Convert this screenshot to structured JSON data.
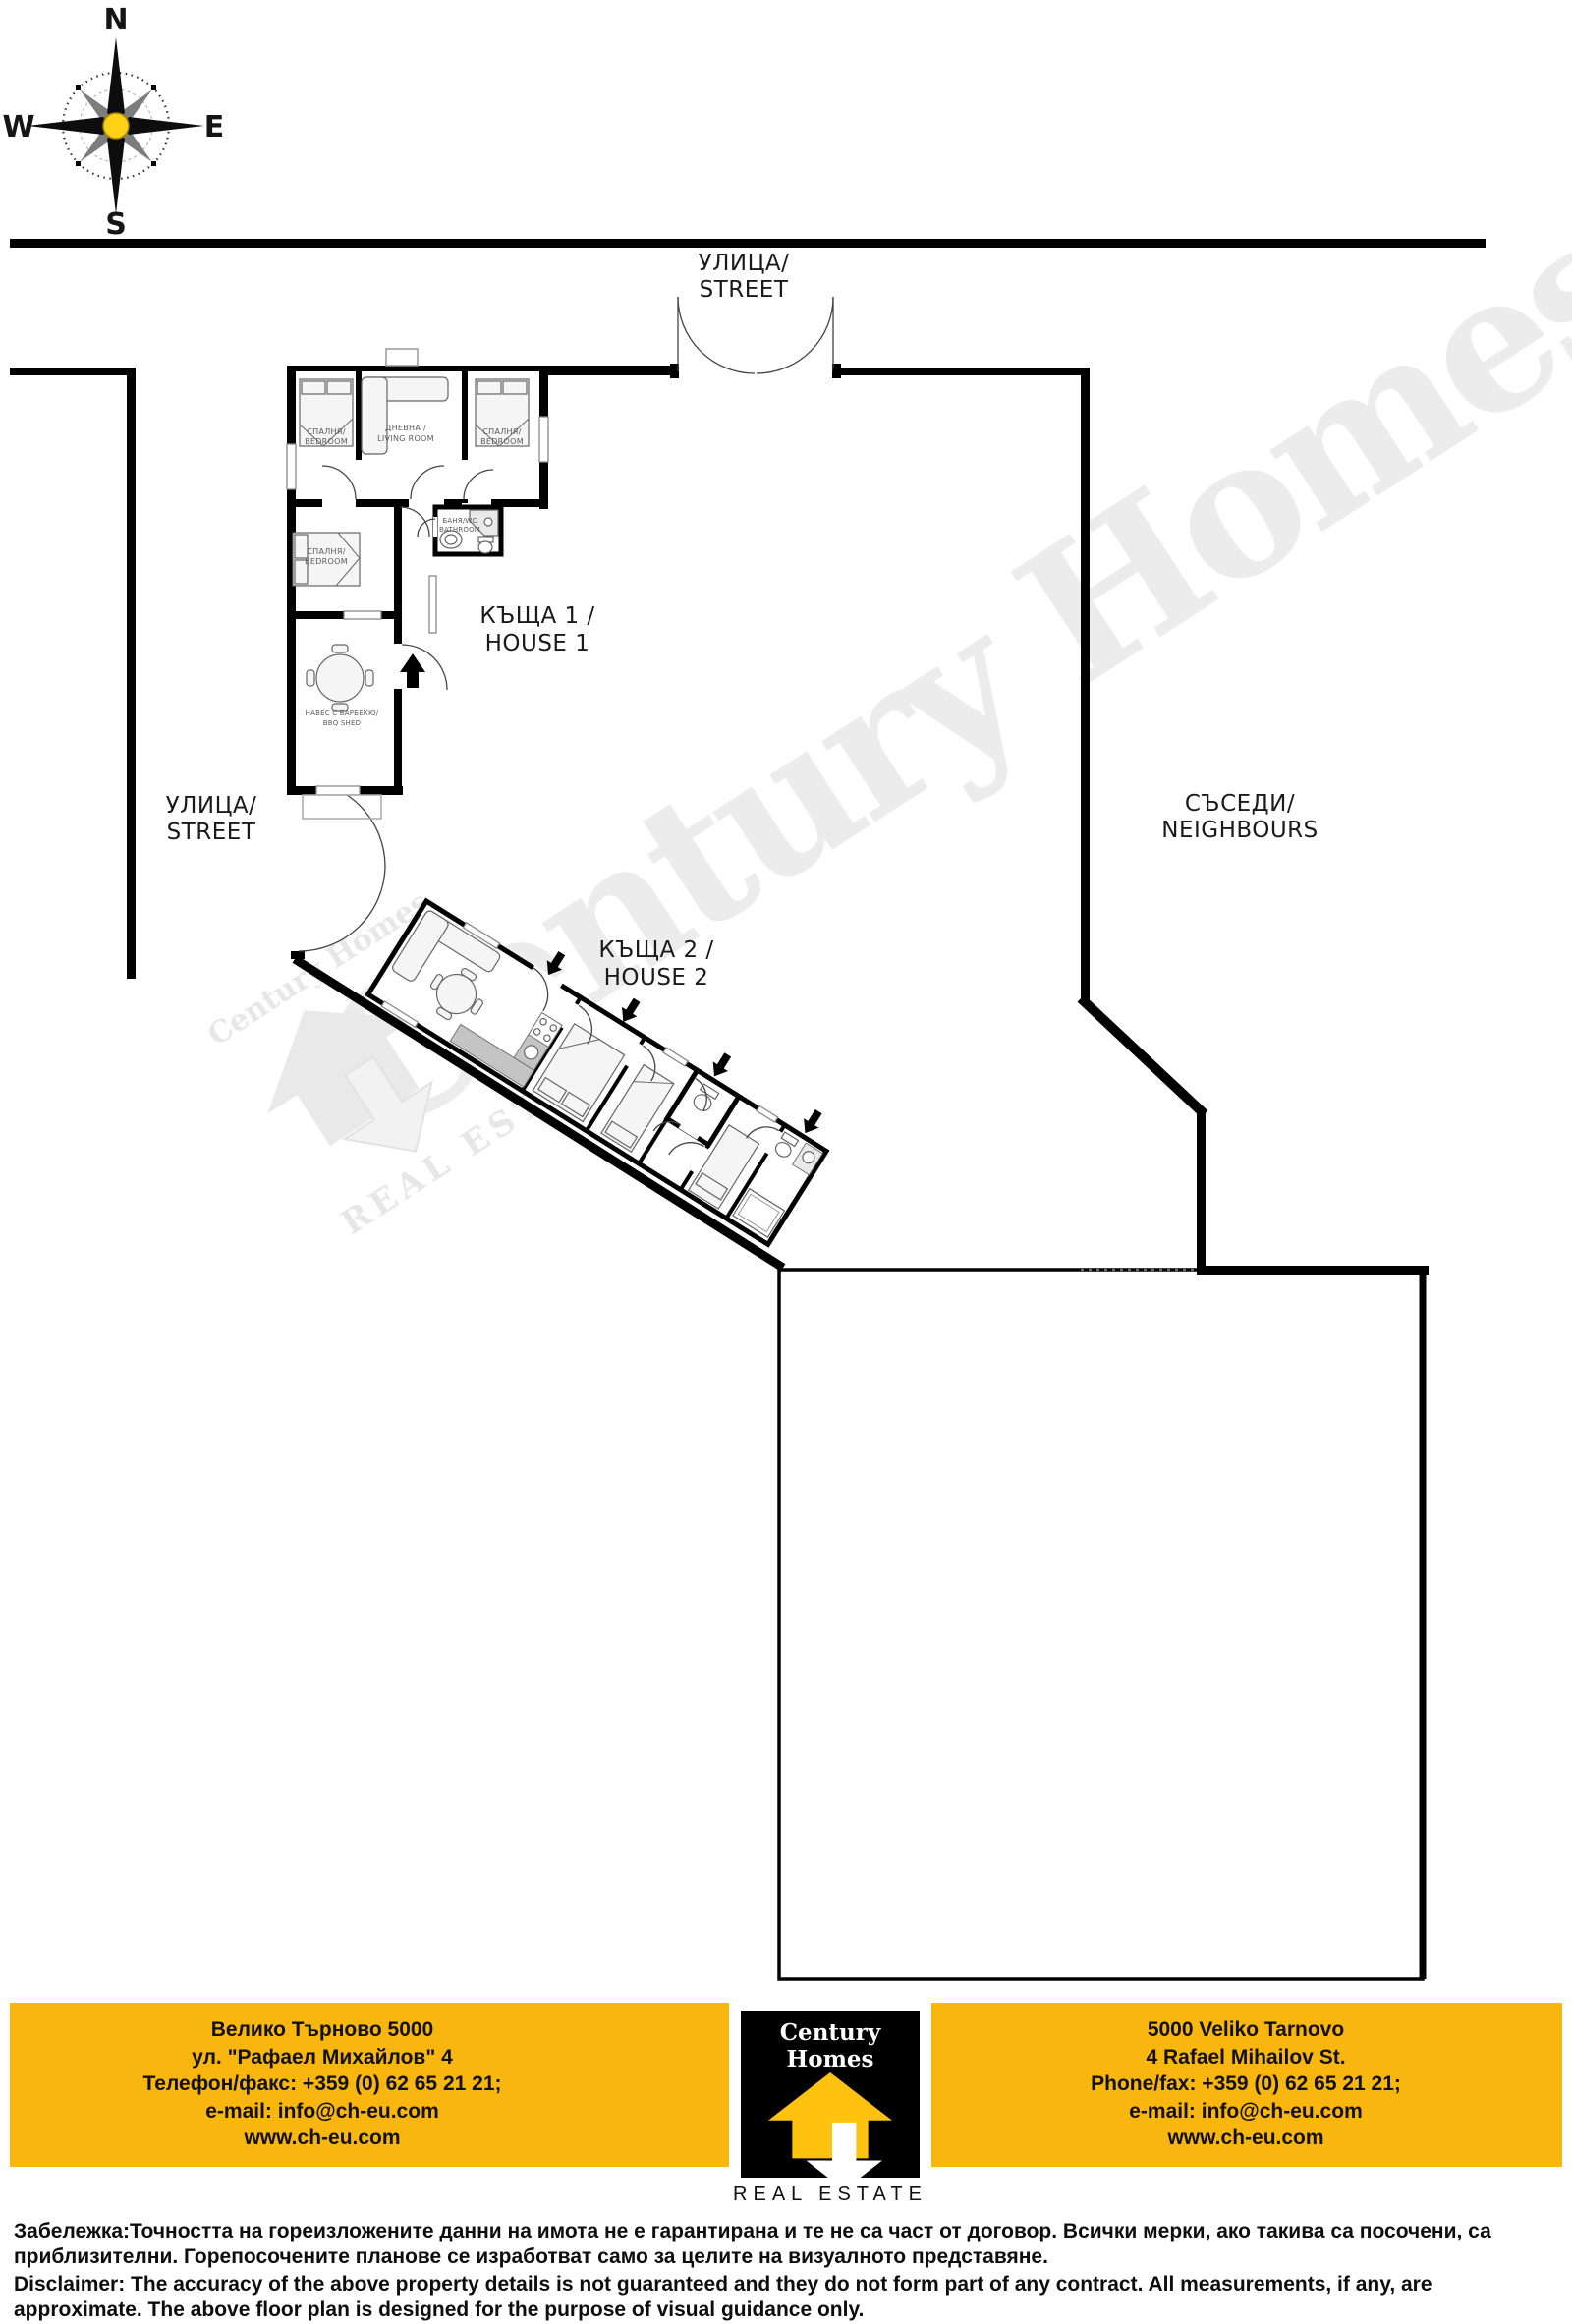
{
  "compass": {
    "n": "N",
    "e": "E",
    "s": "S",
    "w": "W"
  },
  "labels": {
    "street_top": {
      "l1": "УЛИЦА/",
      "l2": "STREET"
    },
    "street_left": {
      "l1": "УЛИЦА/",
      "l2": "STREET"
    },
    "neighbours": {
      "l1": "СЪСЕДИ/",
      "l2": "NEIGHBOURS"
    },
    "house1": {
      "l1": "КЪЩА 1 /",
      "l2": "HOUSE 1"
    },
    "house2": {
      "l1": "КЪЩА 2 /",
      "l2": "HOUSE 2"
    }
  },
  "house1_rooms": {
    "bedroom1": {
      "l1": "СПАЛНЯ/",
      "l2": "BEDROOM"
    },
    "living": {
      "l1": "ДНЕВНА /",
      "l2": "LIVING ROOM"
    },
    "bedroom2": {
      "l1": "СПАЛНЯ/",
      "l2": "BEDROOM"
    },
    "bedroom3": {
      "l1": "СПАЛНЯ/",
      "l2": "BEDROOM"
    },
    "bathroom": {
      "l1": "БАНЯ/WC",
      "l2": "BATHROOM"
    },
    "bbq": {
      "l1": "НАВЕС С БАРБЕКЮ/",
      "l2": "BBQ SHED"
    }
  },
  "watermark": {
    "brand": "Century Homes",
    "tagline": "REAL ESTATE"
  },
  "footer": {
    "bg_yellow": "#F9B60E",
    "left": {
      "line1": "Велико Търново 5000",
      "line2": "ул. \"Рафаел Михайлов\" 4",
      "line3": "Телефон/факс: +359 (0) 62 65 21 21;",
      "line4": "e-mail: info@ch-eu.com",
      "line5": "www.ch-eu.com"
    },
    "right": {
      "line1": "5000 Veliko Tarnovo",
      "line2": "4 Rafael Mihailov St.",
      "line3": "Phone/fax: +359 (0) 62 65 21 21;",
      "line4": "e-mail: info@ch-eu.com",
      "line5": "www.ch-eu.com"
    },
    "logo": {
      "brand": "Century Homes",
      "tagline": "REAL ESTATE",
      "yellow": "#FFC20E"
    }
  },
  "disclaimer": {
    "bg": "Забележка:Точността на гореизложените данни на имота не е гарантирана и те не са част от договор. Всички мерки, ако такива са посочени, са приблизителни. Горепосочените планове се изработват само за целите на визуалното представяне.",
    "en": "Disclaimer: The accuracy of the above property details is not guaranteed and they do not form part of any contract. All measurements, if any, are approximate. The above floor plan is designed for the purpose of visual guidance only."
  }
}
